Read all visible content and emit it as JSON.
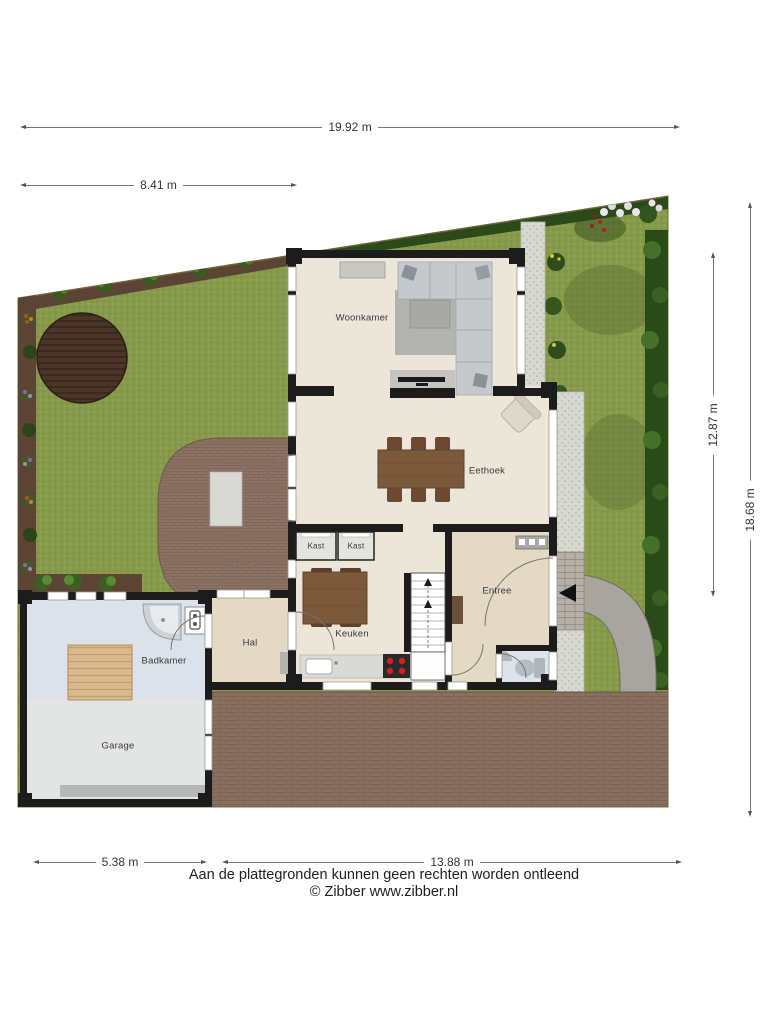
{
  "floorplan": {
    "rooms": [
      {
        "id": "woonkamer",
        "label": "Woonkamer"
      },
      {
        "id": "eethoek",
        "label": "Eethoek"
      },
      {
        "id": "kast-1",
        "label": "Kast"
      },
      {
        "id": "kast-2",
        "label": "Kast"
      },
      {
        "id": "keuken",
        "label": "Keuken"
      },
      {
        "id": "hal",
        "label": "Hal"
      },
      {
        "id": "entree",
        "label": "Entree"
      },
      {
        "id": "badkamer",
        "label": "Badkamer"
      },
      {
        "id": "garage",
        "label": "Garage"
      }
    ],
    "dimensions": {
      "top_total": "19.92 m",
      "top_left": "8.41 m",
      "right_inner": "12.87 m",
      "right_outer": "18.68 m",
      "bottom_left": "5.38 m",
      "bottom_right": "13.88 m"
    },
    "icons": [
      "entrance-arrow-icon",
      "stairs-up-arrow-icon"
    ],
    "colors": {
      "grass": "#87994b",
      "hedge": "#2b4a1a",
      "soil": "#5c4434",
      "deck_wood": "#4a3527",
      "patio_pavers": "#8b7265",
      "driveway_brick": "#8a6e5e",
      "gravel": "#d8d8d2",
      "stone_path": "#a6a69e",
      "wall": "#1c1c1c",
      "floor_main": "#ece6d8",
      "floor_entree": "#e4d9c5",
      "floor_bath": "#dbe2ea",
      "floor_garage": "#e3e4e4",
      "furniture_wood": "#7b5a3c",
      "stove_burner": "#cc2222"
    }
  },
  "footer": {
    "disclaimer": "Aan de plattegronden kunnen geen rechten worden ontleend",
    "credit": "© Zibber www.zibber.nl"
  }
}
